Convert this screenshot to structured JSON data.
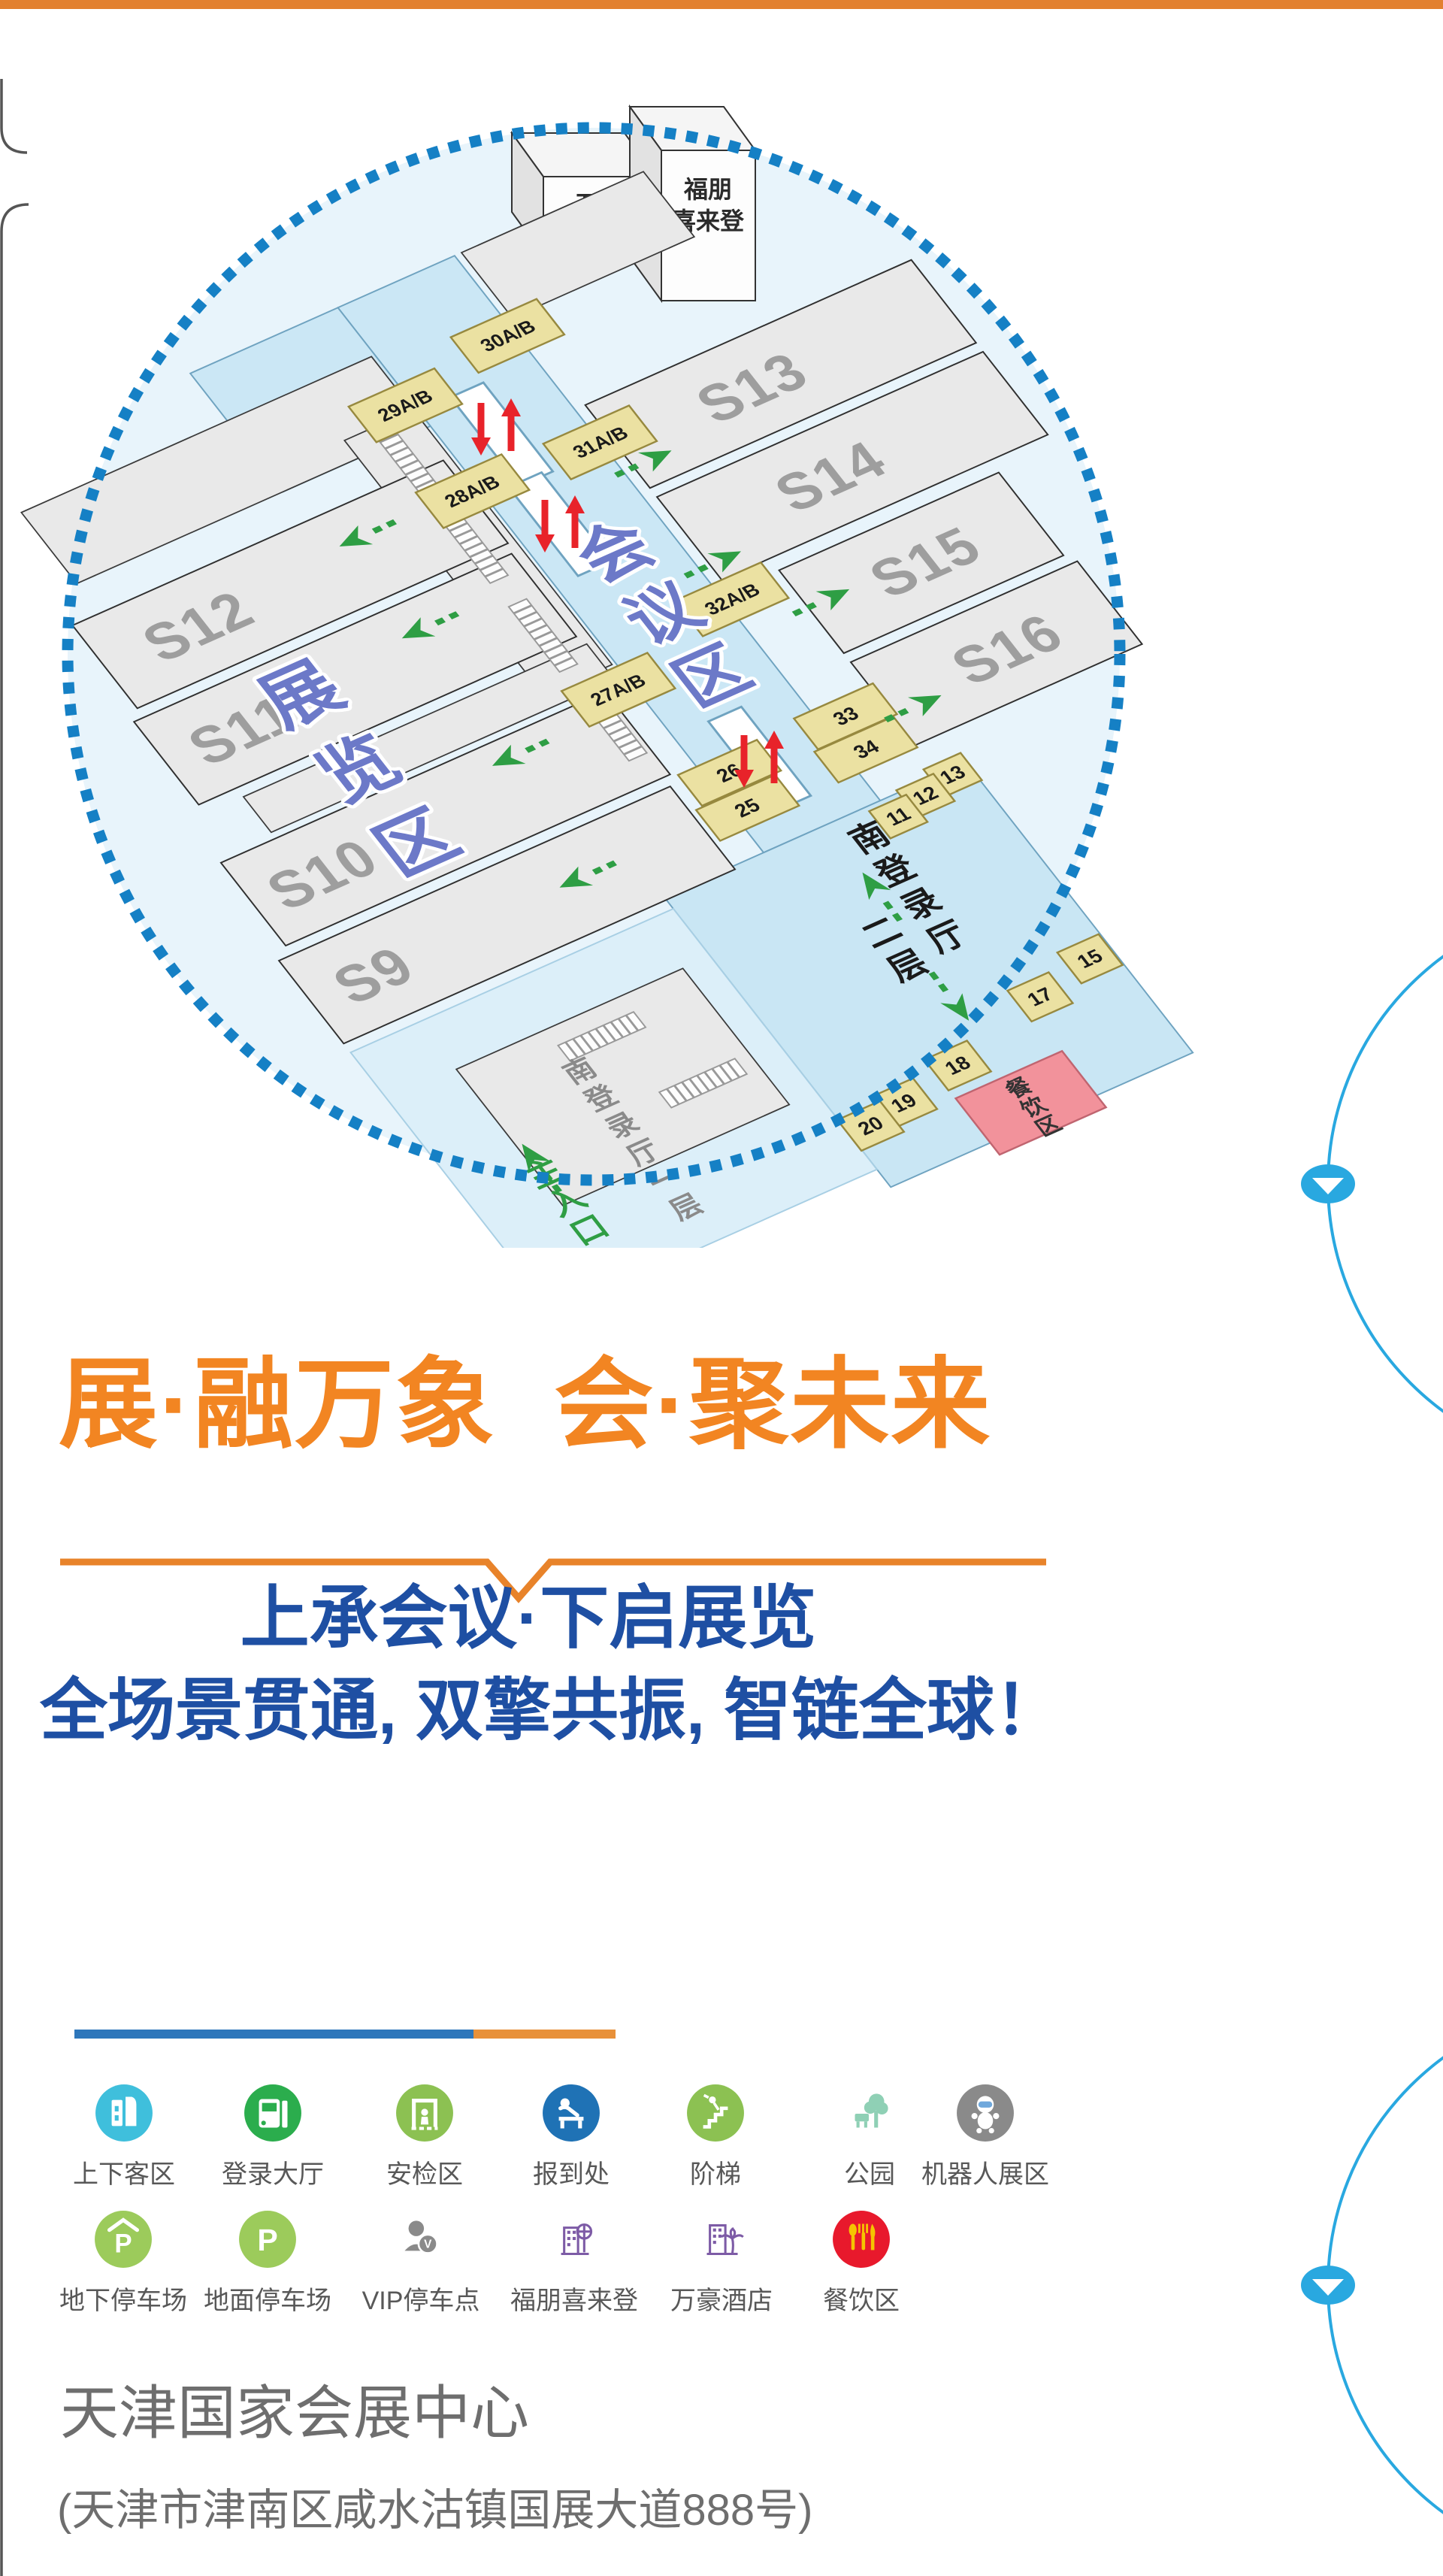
{
  "colors": {
    "top_bar": "#E2802F",
    "accent_orange": "#F28522",
    "accent_blue": "#1E4FA3",
    "map_border_blue": "#1580C5",
    "decor_circle_blue": "#29A8E0",
    "corridor_blue": "#CBE7F5",
    "room_yellow": "#EBE1A2",
    "dining_pink": "#F2929B",
    "hall_gray": "#E9E9E9"
  },
  "map": {
    "halls": [
      "S9",
      "S10",
      "S11",
      "S12",
      "S13",
      "S14",
      "S15",
      "S16"
    ],
    "rooms": {
      "r30": "30A/B",
      "r29": "29A/B",
      "r31": "31A/B",
      "r28": "28A/B",
      "r32": "32A/B",
      "r27": "27A/B",
      "r26": "26",
      "r25": "25",
      "r33": "33",
      "r34": "34",
      "r13": "13",
      "r12": "12",
      "r11": "11",
      "r15": "15",
      "r17": "17",
      "r18": "18",
      "r19": "19",
      "r20": "20"
    },
    "areas": {
      "exhibition": "展览区",
      "conference": "会议区",
      "south_hall_l2_line1": "南登录厅",
      "south_hall_l2_line2": "二层",
      "south_hall_l1": "南登录厅一层",
      "main_entrance": "主入口",
      "dining": "餐饮区"
    },
    "hotels": {
      "marriott_line1": "万豪",
      "marriott_line2": "酒店",
      "four_points_line1": "福朋",
      "four_points_line2": "喜来登"
    }
  },
  "hero": {
    "title": "展·融万象  会·聚未来"
  },
  "subtitle": {
    "line1": "上承会议·下启展览",
    "line2": "全场景贯通, 双擎共振, 智链全球！"
  },
  "legend": {
    "row1": [
      {
        "label": "上下客区"
      },
      {
        "label": "登录大厅"
      },
      {
        "label": "安检区"
      },
      {
        "label": "报到处"
      },
      {
        "label": "阶梯"
      },
      {
        "label": "公园"
      },
      {
        "label": "机器人展区"
      }
    ],
    "row2": [
      {
        "label": "地下停车场"
      },
      {
        "label": "地面停车场"
      },
      {
        "label": "VIP停车点"
      },
      {
        "label": "福朋喜来登"
      },
      {
        "label": "万豪酒店"
      },
      {
        "label": "餐饮区"
      }
    ]
  },
  "footer": {
    "name": "天津国家会展中心",
    "address": "(天津市津南区咸水沽镇国展大道888号)"
  }
}
